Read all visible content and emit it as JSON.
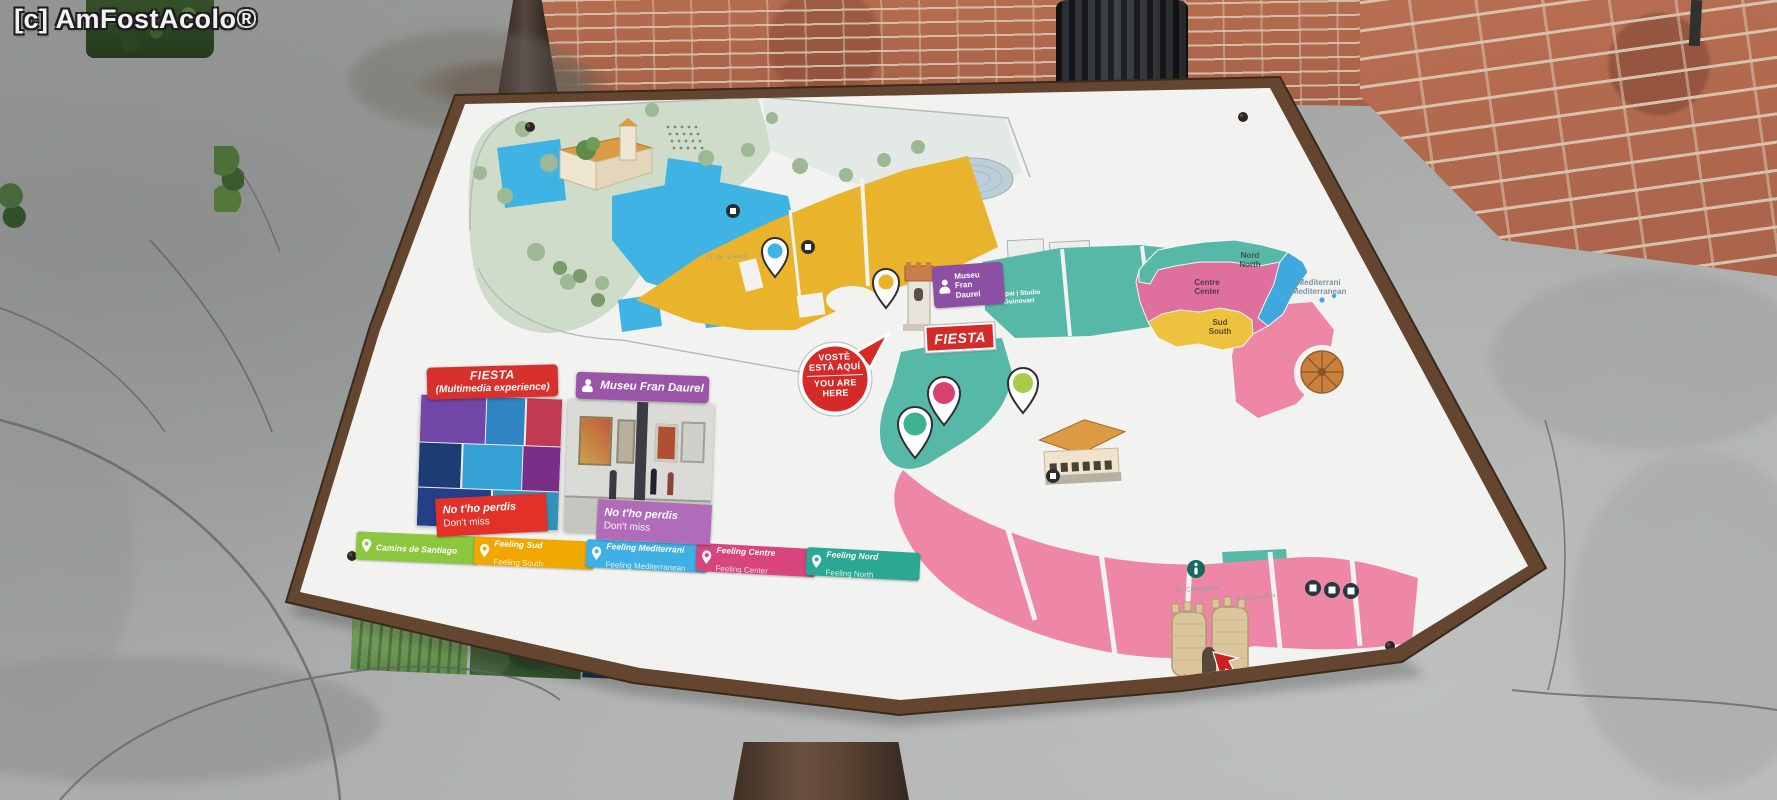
{
  "watermark": "[c] AmFostAcolo®",
  "map": {
    "signs": {
      "fiesta": "FIESTA",
      "museu_line1": "Museu",
      "museu_line2": "Fran",
      "museu_line3": "Daurel",
      "espai_line1": "Espai | Studio",
      "espai_line2": "Guinovart"
    },
    "you_are_here": {
      "ca1": "VOSTÈ",
      "ca2": "ESTÀ AQUÍ",
      "en1": "YOU ARE",
      "en2": "HERE"
    },
    "street_labels": {
      "pl_castellana": "Pl. Castellana",
      "c_consultes": "C. Consultes",
      "pl_font": "Pl. de la Font"
    },
    "inset": {
      "nord_ca": "Nord",
      "nord_en": "North",
      "centre_ca": "Centre",
      "centre_en": "Center",
      "sud_ca": "Sud",
      "sud_en": "South",
      "med_ca": "Mediterrani",
      "med_en": "Mediterranean"
    },
    "colors": {
      "zone_teal": "#56b9a8",
      "zone_pink": "#ee86a6",
      "zone_yellow": "#e9b42c",
      "zone_blue": "#3eb3e4",
      "sign_red": "#d42a28",
      "sign_purple": "#8d4fa4"
    }
  },
  "promos": {
    "fiesta": {
      "title1": "FIESTA",
      "title2": "(Multimedia experience)",
      "badge1": "No t'ho perdis",
      "badge2": "Don't miss"
    },
    "museu": {
      "title": "Museu Fran Daurel",
      "badge1": "No t'ho perdis",
      "badge2": "Don't miss"
    }
  },
  "experiences": [
    {
      "ca": "Camins de Santiago",
      "en": ""
    },
    {
      "ca": "Feeling Sud",
      "en": "Feeling South"
    },
    {
      "ca": "Feeling Mediterrani",
      "en": "Feeling Mediterranean"
    },
    {
      "ca": "Feeling Centre",
      "en": "Feeling Center"
    },
    {
      "ca": "Feeling Nord",
      "en": "Feeling North"
    }
  ]
}
